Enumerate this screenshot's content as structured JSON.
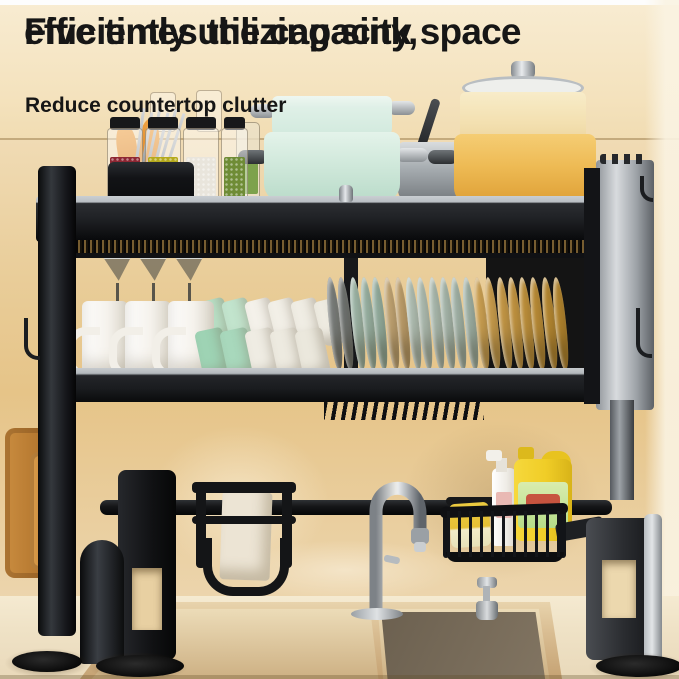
{
  "meta": {
    "image_type": "product-marketing-photo",
    "subject": "over-the-sink black metal dish drying rack in a kitchen",
    "canvas": {
      "width": 679,
      "height": 679
    }
  },
  "headline": {
    "line1": "Five times the capacity,",
    "line2": "efficiently utilizing sink space",
    "subline": "Reduce countertop clutter",
    "text_color": "#161616"
  },
  "palette": {
    "background_cream": "#f4e2bd",
    "wall_gold": "#d8a959",
    "rack_black": "#141517",
    "rack_silver": "#c9ced2",
    "mint_pot": "#d3eadd",
    "yellow_pot": "#eebb55",
    "wood": "#c98c3f",
    "soap_jug_yellow": "#f0cd27",
    "sink_bronze": "#5c5243",
    "counter": "#efe2c6"
  },
  "scene": {
    "top_shelf_items": [
      "utensil-holder with chopsticks",
      "grain storage jars",
      "oil bottle",
      "wood board",
      "mint pot stack",
      "steel pan",
      "glass lid",
      "cream pot",
      "yellow pot"
    ],
    "middle_shelf_items": [
      "wine glasses",
      "white mugs",
      "green and white cups",
      "plate row"
    ],
    "lower_items": [
      "hanging cutting boards",
      "knife holder with knives",
      "chrome faucet",
      "wire basket",
      "sponge",
      "spray bottle",
      "dish soap jug"
    ],
    "bottom_items": [
      "double basin sink",
      "soap dispenser",
      "rack legs with disc feet"
    ],
    "glasses": {
      "count": 3,
      "x0": 103,
      "dx": 36,
      "y": 257
    },
    "mugs": {
      "count": 3,
      "x0": 82,
      "dx": 43,
      "y": 301
    },
    "cups_back": {
      "x0": 203,
      "dx": 23,
      "y": 299,
      "w": 26,
      "h": 46,
      "rot": -14,
      "colors": [
        "#b9e0c6",
        "#c2e4cd",
        "#f4f1ea",
        "#f2efe7",
        "#f0ede4",
        "#eeebe1"
      ]
    },
    "cups_front": {
      "x0": 199,
      "dx": 25,
      "y": 329,
      "w": 28,
      "h": 50,
      "rot": -12,
      "colors": [
        "#9ed3b4",
        "#a8d8bc",
        "#efece3",
        "#edeae0",
        "#ebe8dd"
      ]
    },
    "plates": {
      "x0": 329,
      "dx": 11.3,
      "y": 277,
      "rot": -6,
      "colors": [
        "#8b9294",
        "#7e8587",
        "#b7d6c9",
        "#b1d1c4",
        "#abccbf",
        "#e3c18a",
        "#deba80",
        "#cfe3da",
        "#cbdfd6",
        "#c6dbd2",
        "#c1d7ce",
        "#bcd3ca",
        "#b7cfc6",
        "#f0bd62",
        "#ecb85b",
        "#e8b354",
        "#e4ae4d",
        "#dfa946",
        "#daa440",
        "#d59f3a",
        "#d09a35"
      ]
    },
    "jars": [
      {
        "x": 107,
        "w": 36,
        "fill": "#8e2733",
        "name": "jar-red-beans"
      },
      {
        "x": 145,
        "w": 36,
        "fill": "#b5aa1c",
        "name": "jar-yellow-beans"
      },
      {
        "x": 183,
        "w": 36,
        "fill": "#e9e5dc",
        "name": "jar-white-beans"
      },
      {
        "x": 221,
        "w": 27,
        "fill": "#6f8c36",
        "name": "jar-green-beans"
      }
    ],
    "knives": [
      {
        "x": 202,
        "h": 62,
        "lean": -6
      },
      {
        "x": 228,
        "h": 86,
        "lean": -2
      },
      {
        "x": 256,
        "h": 70,
        "lean": 3
      },
      {
        "x": 275,
        "h": 56,
        "lean": 8
      }
    ],
    "chopsticks": {
      "count": 6,
      "x0": 138,
      "dx": 7,
      "y": 108
    },
    "basket_wires": {
      "count": 11,
      "x0": 447,
      "dx": 11,
      "y": 511
    }
  }
}
